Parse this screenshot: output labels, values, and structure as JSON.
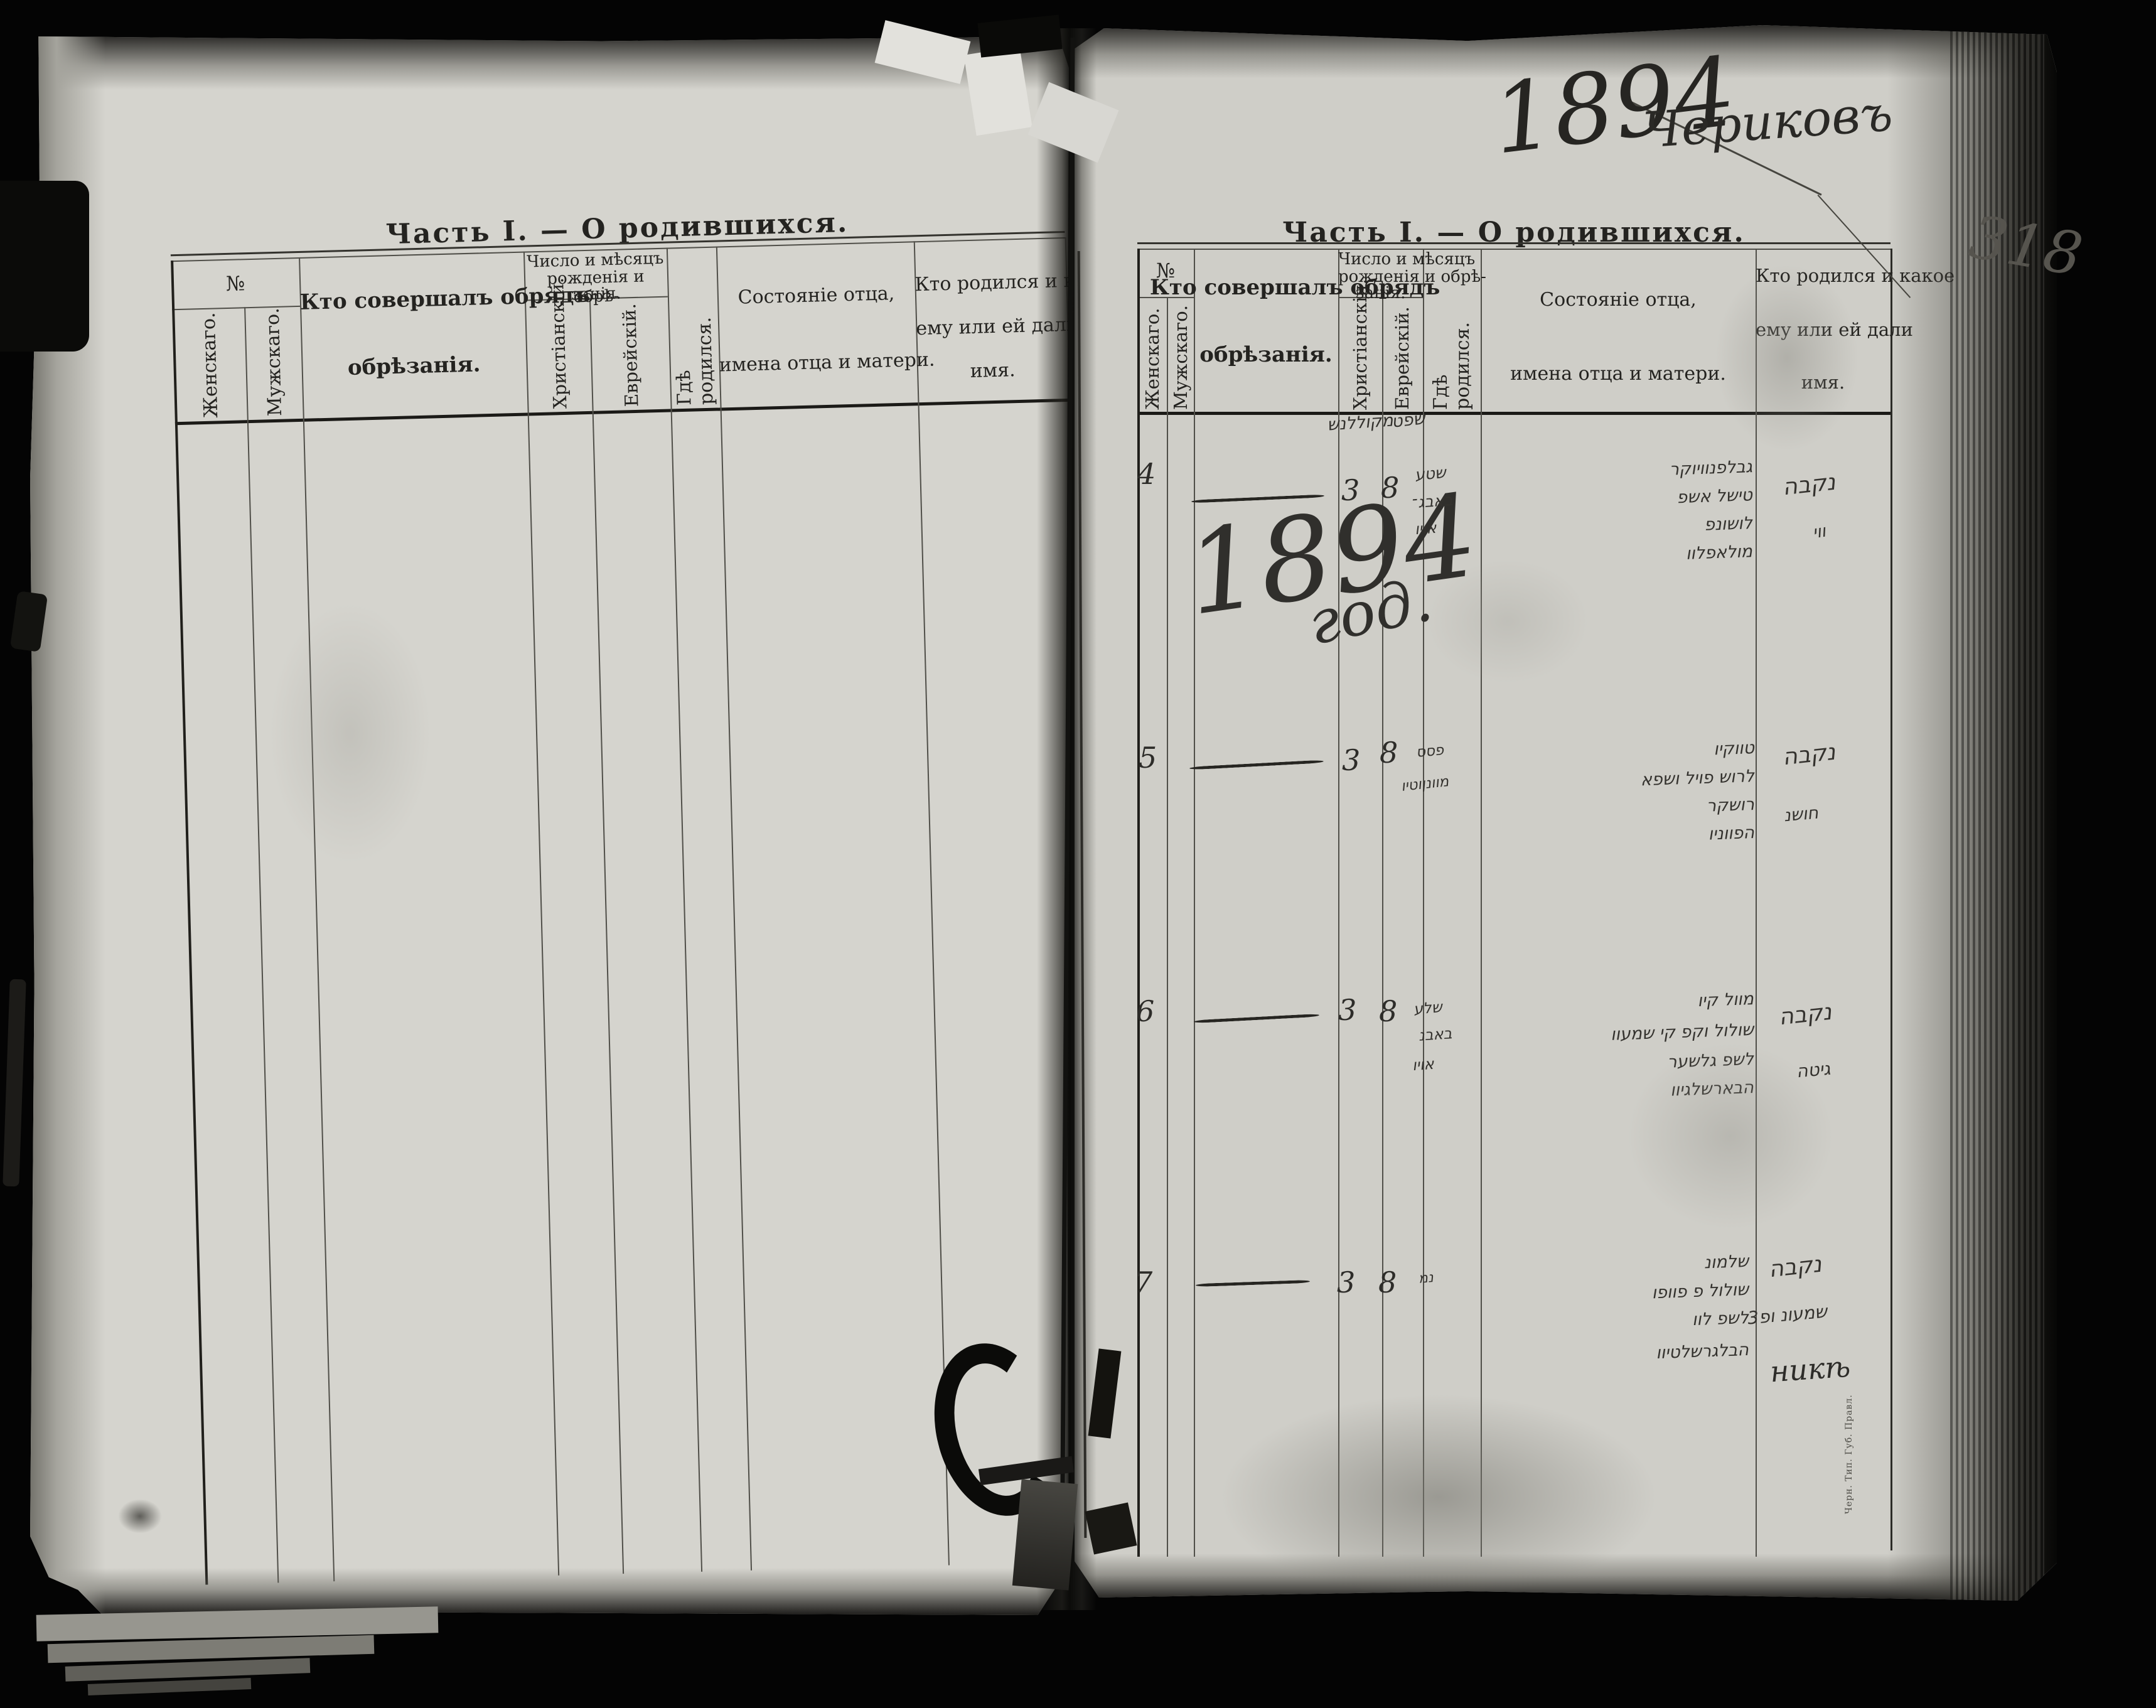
{
  "title": "Часть I. — О родившихся.",
  "columns": {
    "number": "№",
    "female": "Женскаго.",
    "male": "Мужскаго.",
    "who_line1": "Кто совершалъ обрядъ",
    "who_line2": "обрѣзанія.",
    "dates_line1": "Число и мѣсяцъ",
    "dates_line2": "рожденія и обрѣ-",
    "dates_line3": "занія.",
    "christian": "Христіанскій.",
    "jewish": "Еврейскій.",
    "where_born": "Гдѣ родился.",
    "father_line1": "Состояніе отца,",
    "father_line2": "имена отца и матери.",
    "name_line1": "Кто родился и какое",
    "name_line2": "ему или ей дали",
    "name_line3": "имя."
  },
  "annotations": {
    "year": "1894",
    "town": "Чериковъ",
    "folio": "318",
    "year_note_main": "1894",
    "year_note_suffix": "год.",
    "imprint": "Черн. Тип. Губ. Правл.",
    "month_christian": "מקוללנש",
    "month_jewish": "שפט"
  },
  "entries": [
    {
      "number": "4",
      "christian_day": "3",
      "jewish_day": "8",
      "place_lines": [
        "שטע",
        "באבג־",
        "אויו"
      ],
      "father_lines": [
        "גבלפנוויוקר",
        "טישל אשפ",
        "לושונפ",
        "מולאפלוו"
      ],
      "name_lines": [
        "נקבה",
        "ווי"
      ]
    },
    {
      "number": "5",
      "christian_day": "3",
      "jewish_day": "8",
      "place_lines": [
        "פסס",
        "מוונןוטיו"
      ],
      "father_lines": [
        "טווקיו",
        "לרוש פויל ושפא",
        "רושקר",
        "הפווניו"
      ],
      "name_lines": [
        "נקבה",
        "חושנ"
      ]
    },
    {
      "number": "6",
      "christian_day": "3",
      "jewish_day": "8",
      "place_lines": [
        "שלע",
        "באבנ",
        "אויו"
      ],
      "father_lines": [
        "מוול קיו",
        "שולול וקפ קי שמעוו",
        "לשפ גלשער",
        "הבארשלגיוו"
      ],
      "name_lines": [
        "נקבה",
        "גיטה"
      ]
    },
    {
      "number": "7",
      "christian_day": "3",
      "jewish_day": "8",
      "place_lines": [
        "נמ"
      ],
      "father_lines": [
        "שלמונ",
        "שולול פ פוופו",
        "לשפ לוו",
        "הבלגרשלטיוו"
      ],
      "name_lines": [
        "נקבה",
        "שמעונ ופ3",
        "никѣ"
      ]
    }
  ]
}
